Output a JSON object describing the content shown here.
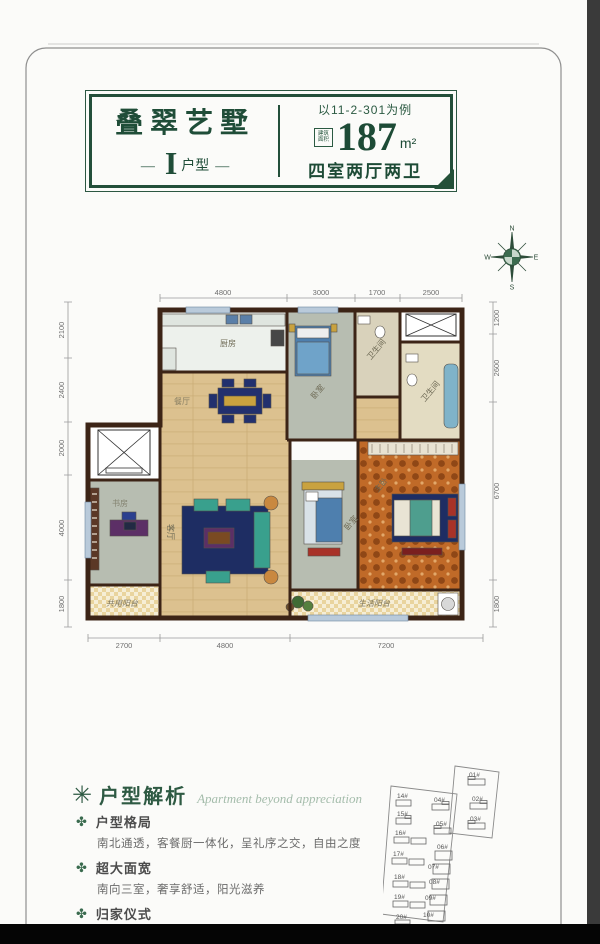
{
  "header": {
    "project_name": "叠翠艺墅",
    "unit_dash": "—",
    "unit_letter": "I",
    "unit_suffix": "户型",
    "example_note": "以11-2-301为例",
    "area_badge_line1": "建筑",
    "area_badge_line2": "面积",
    "area_value": "187",
    "area_unit": "m²",
    "layout_desc": "四室两厅两卫"
  },
  "compass": {
    "n": "N",
    "e": "E",
    "s": "S",
    "w": "W"
  },
  "plan": {
    "dims_top": [
      "4800",
      "3000",
      "1700",
      "2500"
    ],
    "dims_left": [
      "2100",
      "2400",
      "2000",
      "4000",
      "1800"
    ],
    "dims_right": [
      "1200",
      "2600",
      "6700",
      "1800"
    ],
    "dims_bottom": [
      "2700",
      "4800",
      "7200"
    ],
    "rooms": {
      "kitchen": "厨房",
      "dining": "餐厅",
      "bedroom_north": "卧室",
      "bath_north": "卫生间",
      "bath_master": "卫生间",
      "living": "客厅",
      "bedroom_mid": "卧室",
      "master": "主卧",
      "study": "书房",
      "balcony_shared": "共用阳台",
      "balcony_service": "生活阳台"
    }
  },
  "analysis": {
    "icon": "✳",
    "bullet": "✤",
    "title": "户型解析",
    "subtitle": "Apartment beyond appreciation",
    "items": [
      {
        "heading": "户型格局",
        "desc": "南北通透，客餐厨一体化，呈礼序之交，自由之度"
      },
      {
        "heading": "超大面宽",
        "desc": "南向三室，奢享舒适，阳光滋养"
      },
      {
        "heading": "归家仪式",
        "desc": "礼制玄关，尊崇归家仪式，让回家成为一种享受"
      },
      {
        "heading": "瞰湖体验",
        "desc": ""
      }
    ]
  },
  "siteplan": {
    "buildings": [
      "01#",
      "02#",
      "03#",
      "04#",
      "05#",
      "06#",
      "07#",
      "08#",
      "09#",
      "10#",
      "14#",
      "15#",
      "16#",
      "17#",
      "18#",
      "19#",
      "20#"
    ]
  },
  "colors": {
    "accent_green": "#234f3a",
    "wall_brown": "#3c2416",
    "wood_floor": "#dcc18f",
    "carpet_gray": "#b7bdb1",
    "master_orange": "#c06a28",
    "sofa_teal": "#39a08d",
    "rug_navy": "#1e2d63"
  }
}
